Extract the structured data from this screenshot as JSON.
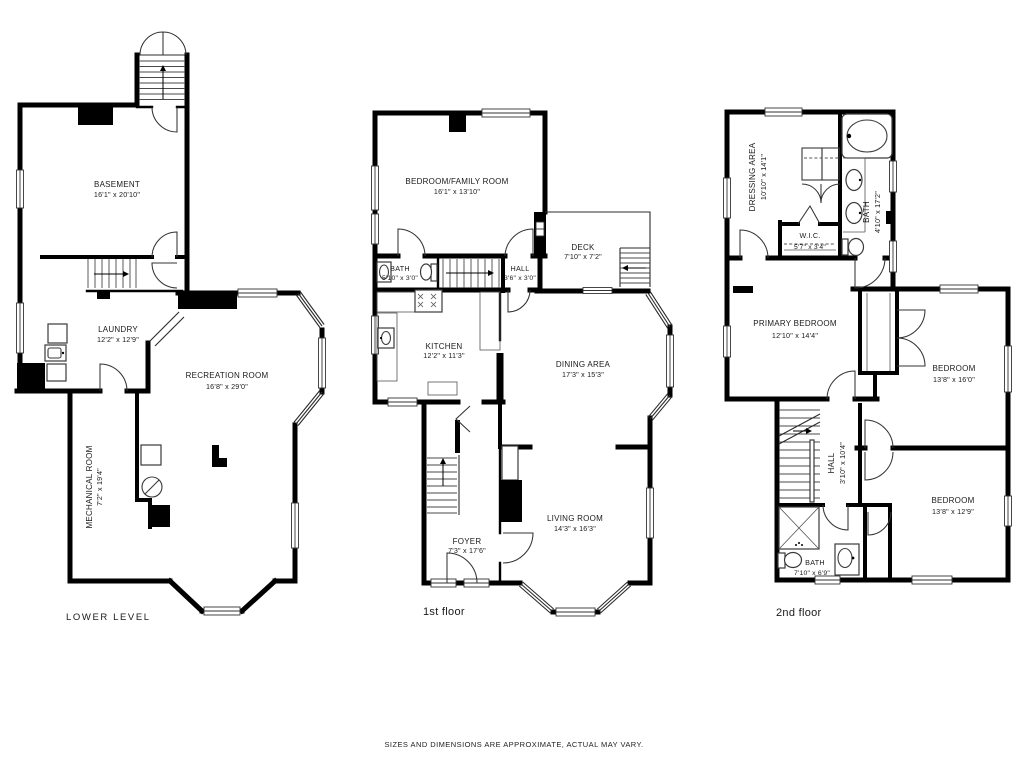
{
  "colors": {
    "background": "#ffffff",
    "walls": "#000000",
    "thin_lines": "#333333",
    "text": "#1a1a1a"
  },
  "footer": {
    "disclaimer": "SIZES AND DIMENSIONS ARE APPROXIMATE, ACTUAL MAY VARY."
  },
  "floors": [
    {
      "caption": "LOWER LEVEL",
      "rooms": [
        {
          "name": "BASEMENT",
          "dims": "16'1\" x 20'10\""
        },
        {
          "name": "LAUNDRY",
          "dims": "12'2\" x 12'9\""
        },
        {
          "name": "RECREATION ROOM",
          "dims": "16'8\" x 29'0\""
        },
        {
          "name": "MECHANICAL ROOM",
          "dims": "7'2\" x 19'4\""
        }
      ]
    },
    {
      "caption": "1st floor",
      "rooms": [
        {
          "name": "BEDROOM/FAMILY ROOM",
          "dims": "16'1\" x 13'10\""
        },
        {
          "name": "BATH",
          "dims": "5'10\" x 3'0\""
        },
        {
          "name": "HALL",
          "dims": "3'6\" x 3'0\""
        },
        {
          "name": "DECK",
          "dims": "7'10\" x 7'2\""
        },
        {
          "name": "KITCHEN",
          "dims": "12'2\" x 11'3\""
        },
        {
          "name": "DINING AREA",
          "dims": "17'3\" x 15'3\""
        },
        {
          "name": "FOYER",
          "dims": "7'3\" x 17'6\""
        },
        {
          "name": "LIVING ROOM",
          "dims": "14'3\" x 16'3\""
        }
      ]
    },
    {
      "caption": "2nd floor",
      "rooms": [
        {
          "name": "DRESSING AREA",
          "dims": "10'10\" x 14'1\""
        },
        {
          "name": "W.I.C.",
          "dims": "5'7\" x 3'4\""
        },
        {
          "name": "BATH",
          "dims": "4'10\" x 17'2\""
        },
        {
          "name": "PRIMARY BEDROOM",
          "dims": "12'10\" x 14'4\""
        },
        {
          "name": "BEDROOM",
          "dims": "13'8\" x 16'0\""
        },
        {
          "name": "HALL",
          "dims": "3'10\" x 10'4\""
        },
        {
          "name": "BEDROOM",
          "dims": "13'8\" x 12'9\""
        },
        {
          "name": "BATH",
          "dims": "7'10\" x 6'9\""
        }
      ]
    }
  ]
}
